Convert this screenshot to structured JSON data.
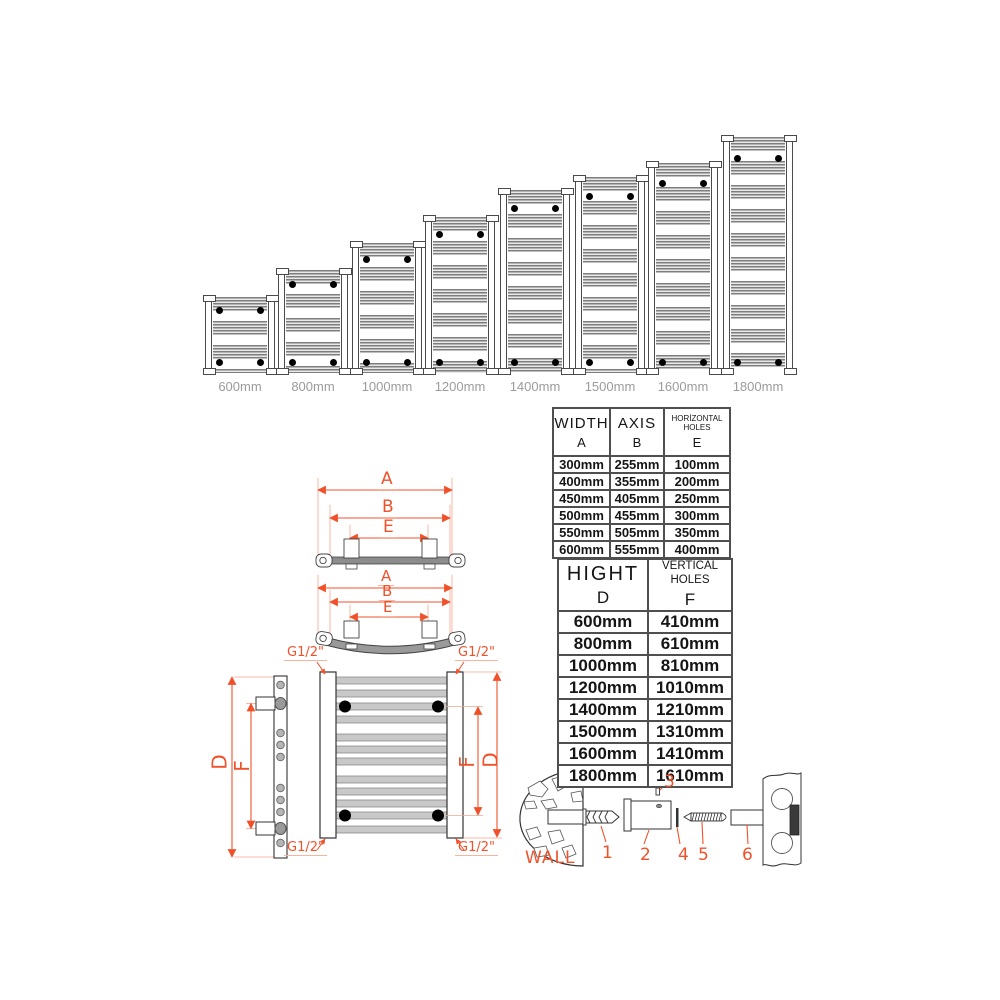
{
  "accent_color": "#f0512a",
  "radiator_series": {
    "unit_scale_px_per_mm": 0.1335,
    "items": [
      {
        "label": "600mm",
        "height_mm": 600
      },
      {
        "label": "800mm",
        "height_mm": 800
      },
      {
        "label": "1000mm",
        "height_mm": 1000
      },
      {
        "label": "1200mm",
        "height_mm": 1200
      },
      {
        "label": "1400mm",
        "height_mm": 1400
      },
      {
        "label": "1500mm",
        "height_mm": 1500
      },
      {
        "label": "1600mm",
        "height_mm": 1600
      },
      {
        "label": "1800mm",
        "height_mm": 1800
      }
    ]
  },
  "top_view_straight": {
    "dim_a": "A",
    "dim_b": "B",
    "dim_e": "E"
  },
  "top_view_curved": {
    "dim_a": "A",
    "dim_b": "B",
    "dim_e": "E"
  },
  "connection_labels": {
    "top_left": "G1/2\"",
    "top_right": "G1/2\"",
    "bottom_left": "G1/2\"",
    "bottom_right": "G1/2\""
  },
  "side_view": {
    "dim_d": "D",
    "dim_f": "F"
  },
  "front_view": {
    "dim_d": "D",
    "dim_f": "F"
  },
  "width_table": {
    "col1_title": "WIDTH",
    "col1_letter": "A",
    "col2_title": "AXIS",
    "col2_letter": "B",
    "col3_title": "HORİZONTAL HOLES",
    "col3_letter": "E",
    "rows": [
      [
        "300mm",
        "255mm",
        "100mm"
      ],
      [
        "400mm",
        "355mm",
        "200mm"
      ],
      [
        "450mm",
        "405mm",
        "250mm"
      ],
      [
        "500mm",
        "455mm",
        "300mm"
      ],
      [
        "550mm",
        "505mm",
        "350mm"
      ],
      [
        "600mm",
        "555mm",
        "400mm"
      ]
    ]
  },
  "height_table": {
    "col1_title": "HIGHT",
    "col1_letter": "D",
    "col2_title": "VERTICAL HOLES",
    "col2_letter": "F",
    "rows": [
      [
        "600mm",
        "410mm"
      ],
      [
        "800mm",
        "610mm"
      ],
      [
        "1000mm",
        "810mm"
      ],
      [
        "1200mm",
        "1010mm"
      ],
      [
        "1400mm",
        "1210mm"
      ],
      [
        "1500mm",
        "1310mm"
      ],
      [
        "1600mm",
        "1410mm"
      ],
      [
        "1800mm",
        "1610mm"
      ]
    ]
  },
  "mounting_kit": {
    "wall_label": "WALL",
    "part_numbers": [
      "1",
      "2",
      "3",
      "4",
      "5",
      "6"
    ]
  }
}
